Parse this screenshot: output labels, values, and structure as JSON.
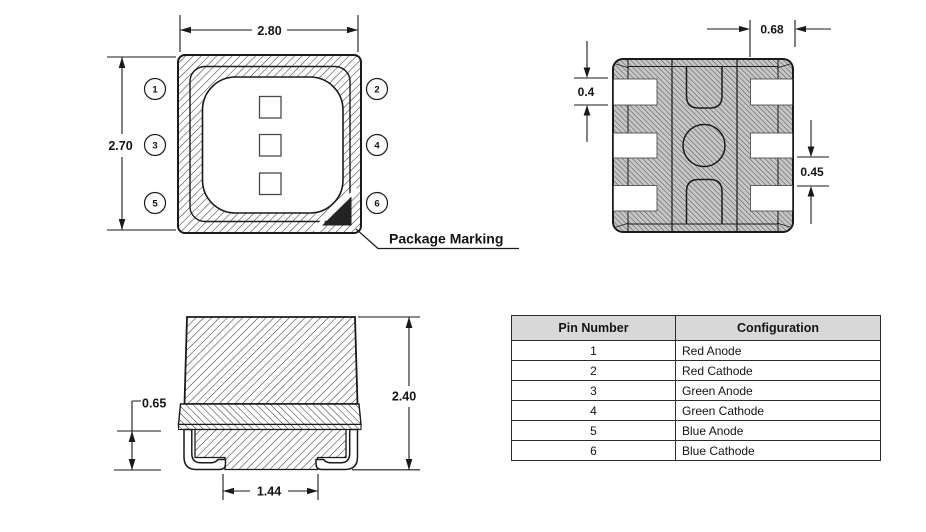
{
  "top_view": {
    "dim_width": "2.80",
    "dim_height": "2.70",
    "pins": [
      "1",
      "2",
      "3",
      "4",
      "5",
      "6"
    ],
    "package_marking_label": "Package Marking"
  },
  "bottom_view": {
    "dim_pad_width": "0.68",
    "dim_pad_height": "0.4",
    "dim_pad_pitch": "0.45"
  },
  "side_view": {
    "dim_total_height": "2.40",
    "dim_lead_height": "0.65",
    "dim_bottom_pad_width": "1.44"
  },
  "pin_table": {
    "headers": {
      "pin": "Pin Number",
      "config": "Configuration"
    },
    "rows": [
      {
        "pin": "1",
        "config": "Red Anode"
      },
      {
        "pin": "2",
        "config": "Red Cathode"
      },
      {
        "pin": "3",
        "config": "Green Anode"
      },
      {
        "pin": "4",
        "config": "Green Cathode"
      },
      {
        "pin": "5",
        "config": "Blue Anode"
      },
      {
        "pin": "6",
        "config": "Blue Cathode"
      }
    ]
  },
  "colors": {
    "line": "#1a1a1a",
    "table_header_bg": "#d8d8d8",
    "marking_triangle": "#232323",
    "bottom_view_fill": "#c6c6c6"
  }
}
